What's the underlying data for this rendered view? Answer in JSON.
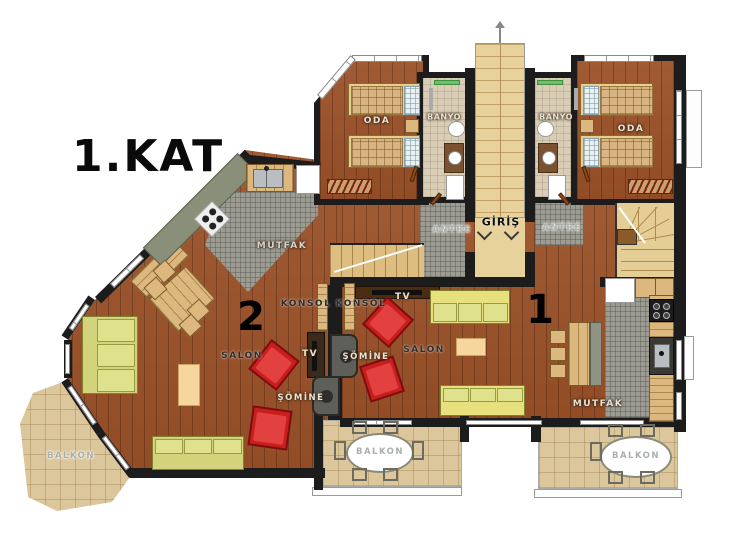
{
  "fp": {
    "title": "1.KAT",
    "units": {
      "left": "2",
      "right": "1"
    },
    "rooms": {
      "bedroom": "ODA",
      "bathroom": "BANYO",
      "entrance": "GİRİŞ",
      "hallway": "ANTRE",
      "kitchen": "MUTFAK",
      "living_room": "SALON",
      "console": "KONSOL",
      "tv": "TV",
      "fireplace": "ŞÖMİNE",
      "balcony": "BALKON"
    },
    "colors": {
      "wall": "#1c1c1c",
      "wood_floor": "#9a5128",
      "kitchen_tile": "#9d9c93",
      "balcony_tile": "#dcc69c",
      "stair_wood": "#e8d29b",
      "sofa_green": "#d2d37a",
      "armchair_red": "#c81e1e"
    }
  }
}
